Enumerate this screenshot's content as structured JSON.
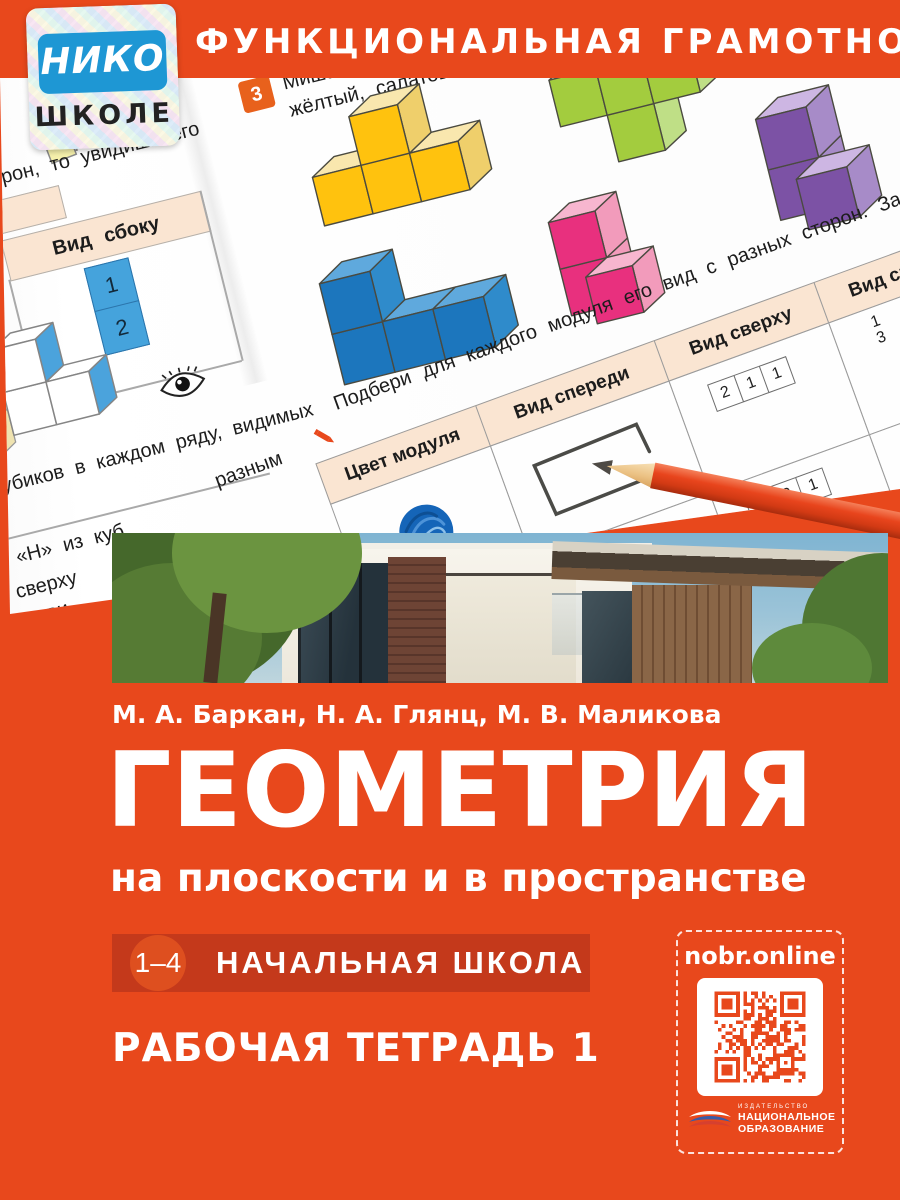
{
  "colors": {
    "cover_orange": "#E8481C",
    "badge_bar_red": "#C4391B",
    "badge_circle_orange": "#DE4F1F",
    "sticker_blue": "#1E97D4",
    "table_header_peach": "#FAE5D2",
    "pencil_red": "#E8451D",
    "qr_module_orange": "#E8481C",
    "worksheet_blue": "#45A3DC"
  },
  "icons": {
    "eye": "eye-icon",
    "task_pencil": "pencil-icon",
    "glue": "glue-stick-icon",
    "sticky_notes": "sticky-notes-icon",
    "qr": "qr-code",
    "publisher_bird": "publisher-bird-logo"
  },
  "top_band": {
    "series_title": "ФУНКЦИОНАЛЬНАЯ ГРАМОТНОСТЬ"
  },
  "sticker": {
    "brand": "НИКО",
    "audience": "ШКОЛЕ"
  },
  "worksheet": {
    "task_number": "3",
    "task_line1": "Миша соор",
    "task_line2": "жёлтый, салатовы",
    "fragment_top_left": "рон, то увидишь его",
    "side_view_header": "Вид сбоку",
    "side_view_cells": [
      "1",
      "2"
    ],
    "fragment_rows": "убиков в каждом ряду, видимых",
    "fragment_h": "и «Н» из куб",
    "fragment_sverhu": "сверху",
    "fragment_ovi": "ови",
    "fragment_raznym": "разным",
    "instruction": "Подбери для каждого модуля его вид с разных сторон. Заполни табли",
    "table_headers": [
      "Цвет модуля",
      "Вид спереди",
      "Вид сверху",
      "Вид справа"
    ],
    "top_view_row1": [
      "2",
      "1",
      "1"
    ],
    "top_view_row2": [
      "1",
      "2",
      "1"
    ],
    "right_view_row1": [
      "1",
      "3"
    ],
    "right_view_row2": [
      "2"
    ],
    "modules": [
      {
        "name": "yellow",
        "front": "#FFC20E",
        "top": "#F9E7AE",
        "side": "#EFCF6B",
        "size": 50,
        "cells": [
          [
            1,
            0,
            0
          ],
          [
            0,
            1,
            0
          ],
          [
            1,
            1,
            0
          ],
          [
            2,
            1,
            0
          ]
        ]
      },
      {
        "name": "green",
        "front": "#A3CC3E",
        "top": "#D8EBB0",
        "side": "#BFDF86",
        "size": 48,
        "cells": [
          [
            0,
            0,
            0
          ],
          [
            1,
            0,
            0
          ],
          [
            2,
            0,
            0
          ],
          [
            1,
            1,
            0
          ]
        ]
      },
      {
        "name": "pink",
        "front": "#E8307E",
        "top": "#F7B6CF",
        "side": "#F29BBB",
        "size": 48,
        "cells": [
          [
            0,
            0,
            1
          ],
          [
            0,
            1,
            1
          ],
          [
            1,
            1,
            0
          ]
        ]
      },
      {
        "name": "purple",
        "front": "#7C52A5",
        "top": "#CDB6E3",
        "side": "#A78BC8",
        "size": 52,
        "cells": [
          [
            0,
            0,
            1
          ],
          [
            0,
            1,
            1
          ],
          [
            1,
            1,
            0
          ]
        ]
      },
      {
        "name": "blue",
        "front": "#1C76BD",
        "top": "#5FA9DD",
        "side": "#2F8BCB",
        "size": 52,
        "cells": [
          [
            0,
            0,
            0
          ],
          [
            0,
            1,
            0
          ],
          [
            1,
            1,
            0
          ],
          [
            2,
            1,
            0
          ]
        ]
      }
    ]
  },
  "authors": "М. А. Баркан, Н. А. Глянц, М. В. Маликова",
  "title": "ГЕОМЕТРИЯ",
  "subtitle": "на плоскости и в пространстве",
  "grade_badge": {
    "range": "1–4",
    "label": "НАЧАЛЬНАЯ ШКОЛА"
  },
  "workbook_label": "РАБОЧАЯ ТЕТРАДЬ 1",
  "qr": {
    "label": "nobr.online"
  },
  "publisher": {
    "kicker": "ИЗДАТЕЛЬСТВО",
    "name_line1": "НАЦИОНАЛЬНОЕ",
    "name_line2": "ОБРАЗОВАНИЕ"
  }
}
